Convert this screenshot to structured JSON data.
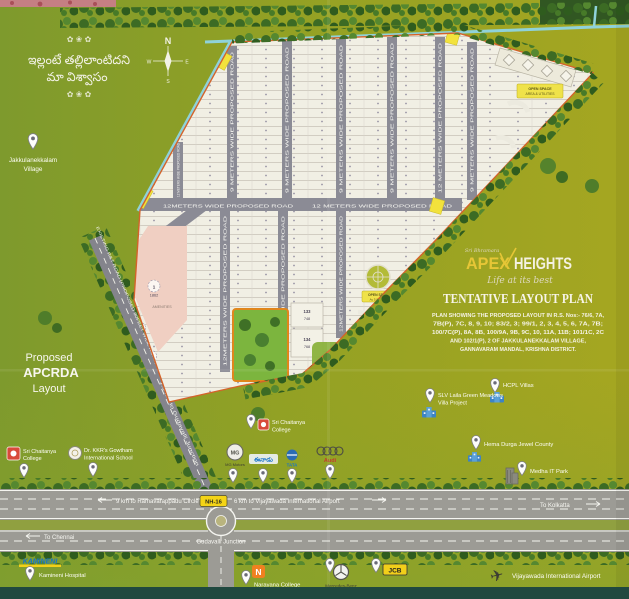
{
  "quote": {
    "flourish_top": "✿ ❀ ✿",
    "line1": "ఇల్లంటే తల్లిలాంటిదని",
    "line2": "మా విశ్వాసం",
    "flourish_bottom": "✿ ❀ ✿"
  },
  "compass": {
    "n": "N",
    "e": "E",
    "s": "S",
    "w": "W"
  },
  "village": {
    "line1": "Jakkulanekkalam",
    "line2": "Village"
  },
  "apcrda": {
    "line1": "Proposed",
    "line2": "APCRDA",
    "line3": "Layout"
  },
  "brand": {
    "pre": "Sri Bhramara",
    "name1": "APEX",
    "name2": "HEIGHTS",
    "tagline": "Life at its best",
    "plan_title": "TENTATIVE LAYOUT PLAN",
    "desc1": "PLAN SHOWING THE PROPOSED LAYOUT IN R.S. Nos:- 76/6, 7A,",
    "desc2": "7B(P), 7C, 8, 9, 10; 83/2, 3; 99/1, 2, 3, 4, 5, 6, 7A, 7B;",
    "desc3": "100/7C(P), 8A, 8B, 100/9A, 9B, 9C, 10, 11A, 11B; 101/1C, 2C",
    "desc4": "AND 102/1(P), 2 OF JAKKULANEKKALAM VILLAGE,",
    "desc5": "GANNAVARAM MANDAL, KRISHNA DISTRICT."
  },
  "roads": {
    "v9": "9 METERS WIDE PROPOSED ROAD",
    "v12": "12 METERS WIDE PROPOSED ROAD",
    "h12a": "12METERS WIDE PROPOSED ROAD",
    "h12b": "12 METERS WIDE PROPOSED ROAD",
    "rt": "EXISTING R&T ROAD (PROPOSED 80FEET WIDE ROAD)",
    "rt_dist": "1.5 km to Gudavalli Junction"
  },
  "layout": {
    "amenities": "AMENITIES",
    "plot1_no": "1",
    "plot1_area": "1862",
    "plot2_no": "2",
    "plot2_area": "713",
    "plot3_no": "3",
    "plot3_area": "789",
    "plot133_no": "133",
    "plot133_area": "748",
    "plot134_no": "134",
    "plot134_area": "768",
    "open_top1": "OPEN SPACE",
    "open_top2": "AREA & UTILITIES",
    "open_mid1": "OPEN SPACE",
    "open_mid2": "Ac 5.09 Cents"
  },
  "highway": {
    "nh": "NH-16",
    "west": "9 km to Ramavarappadu Circle",
    "east": "6 km to Vijayawada International Airport",
    "chennai": "To Chennai",
    "kolkatta": "To Kolkatta",
    "junction": "Gudavalli Junction"
  },
  "landmarks": {
    "sri_chaitanya_left1": "Sri Chaitanya",
    "sri_chaitanya_left2": "College",
    "gowtham1": "Dr. KKR's Gowtham",
    "gowtham2": "International School",
    "sri_chaitanya_mid1": "Sri Chaitanya",
    "sri_chaitanya_mid2": "College",
    "mg_logo": "MG",
    "mg": "MG Motors",
    "eenadu_logo": "ఈనాడు",
    "tata_logo": "TATA",
    "audi_logo": "Audi",
    "hcpl": "HCPL Villas",
    "slv1": "SLV Laila Green Meadows",
    "slv2": "Villa Project",
    "hema": "Hema Durga Jewel County",
    "medha": "Medha IT Park",
    "kamineni_logo": "KAMINENI",
    "kamineni": "Kamineni Hospital",
    "narayana_logo": "N",
    "narayana": "Narayana College",
    "mercedes": "Mercedes-Benz",
    "jcb_logo": "JCB",
    "airport": "Vijayawada International Airport"
  }
}
